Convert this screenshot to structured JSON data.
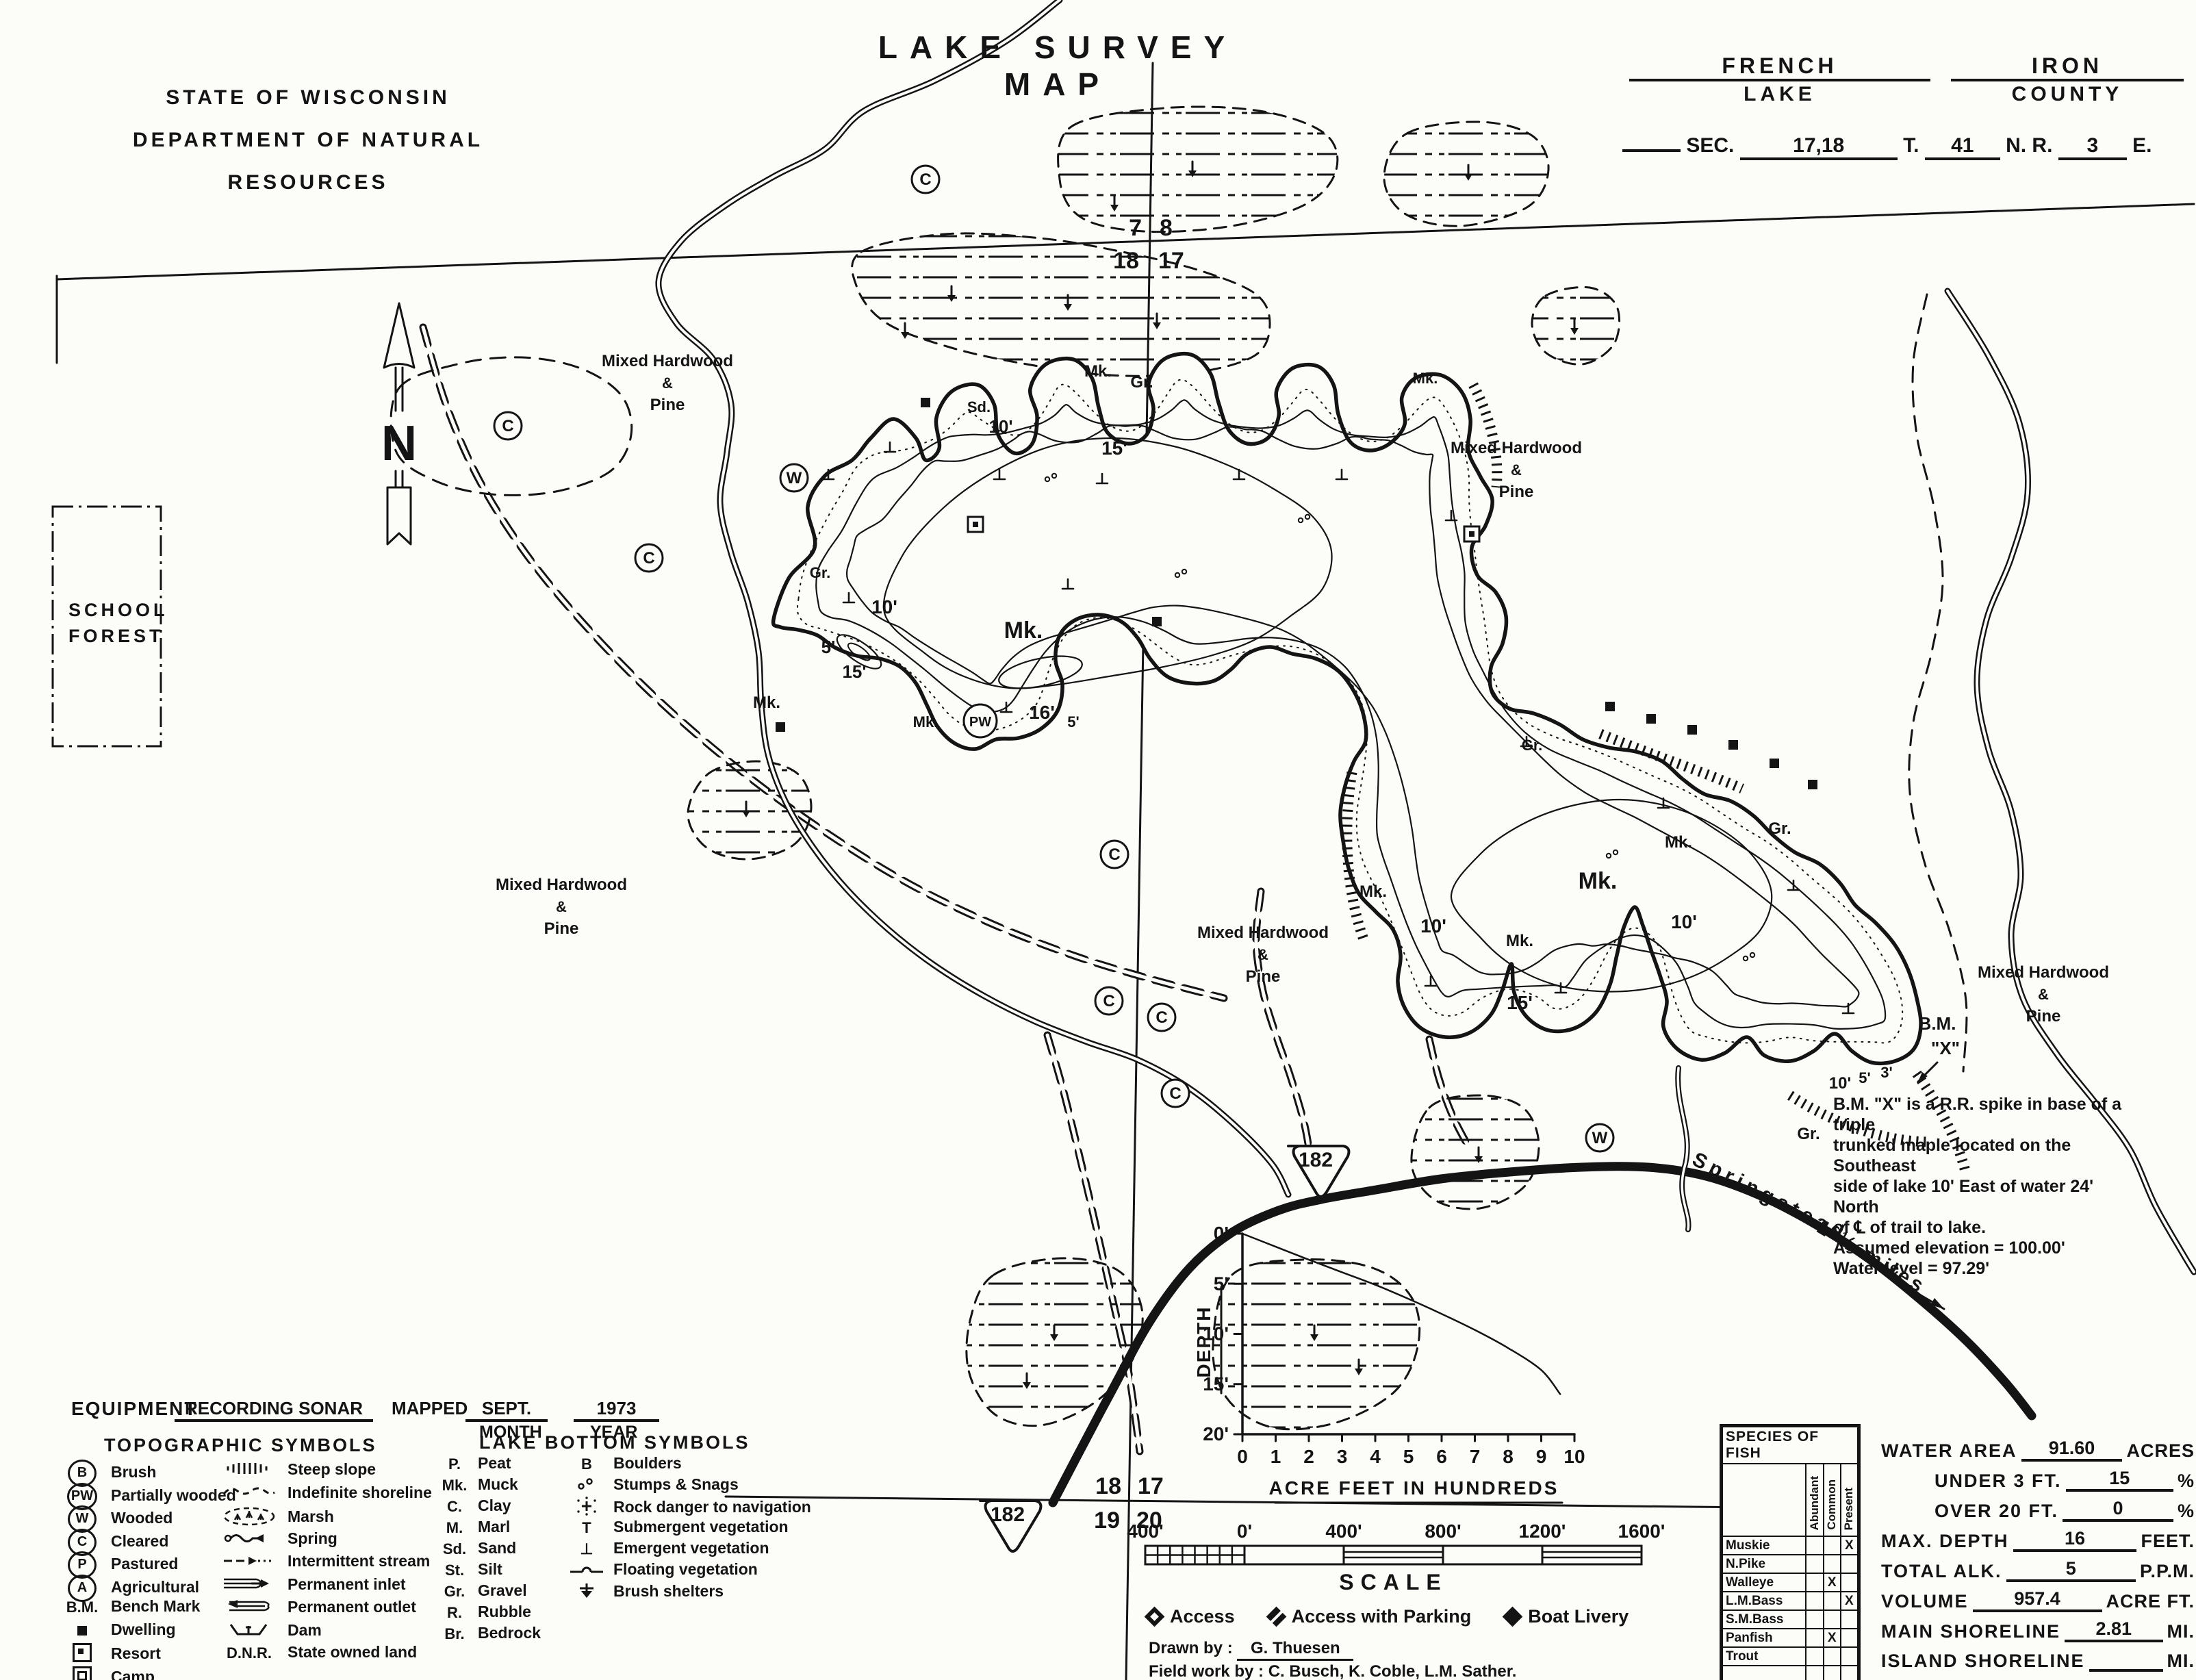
{
  "header": {
    "agency_line1": "STATE OF WISCONSIN",
    "agency_line2": "DEPARTMENT OF NATURAL RESOURCES",
    "title": "LAKE SURVEY MAP",
    "lake_value": "FRENCH",
    "lake_label": "LAKE",
    "county_value": "IRON",
    "county_label": "COUNTY",
    "sec_label": "SEC.",
    "sec_value": "17,18",
    "t_label": "T.",
    "t_value": "41",
    "nr_label": "N. R.",
    "r_value": "3",
    "e_label": "E."
  },
  "map": {
    "school_forest_line1": "SCHOOL",
    "school_forest_line2": "FOREST",
    "north_letter": "N",
    "forest_label_lines": [
      "Mixed Hardwood",
      "&",
      "Pine"
    ],
    "forest_labels": [
      {
        "x": 975,
        "y": 535
      },
      {
        "x": 2215,
        "y": 662
      },
      {
        "x": 820,
        "y": 1300
      },
      {
        "x": 1845,
        "y": 1370
      },
      {
        "x": 2985,
        "y": 1428
      }
    ],
    "section_corner_top": {
      "ul": "7",
      "ur": "8",
      "ll": "18",
      "lr": "17"
    },
    "section_corner_bottom": {
      "ul": "18",
      "ur": "17",
      "ll": "19",
      "lr": "20"
    },
    "highway_number": "182",
    "road_name": "Springstead",
    "road_distance": "1 ½ miles",
    "bm_label": "B.M.",
    "bm_x_label": "\"X\"",
    "bm_note": [
      "B.M. \"X\" is a R.R. spike in base of a triple",
      "trunked maple located on the Southeast",
      "side of lake 10' East of water 24' North",
      "of ℄ of trail to lake.",
      "Assumed elevation = 100.00'",
      "Water level = 97.29'"
    ],
    "spot_labels": [
      {
        "t": "Mk.",
        "x": 1495,
        "y": 932,
        "s": 34
      },
      {
        "t": "16'",
        "x": 1522,
        "y": 1050,
        "s": 28
      },
      {
        "t": "10'",
        "x": 1292,
        "y": 896,
        "s": 28
      },
      {
        "t": "5'",
        "x": 1210,
        "y": 954,
        "s": 26
      },
      {
        "t": "15'",
        "x": 1248,
        "y": 990,
        "s": 26
      },
      {
        "t": "15'",
        "x": 1628,
        "y": 664,
        "s": 28
      },
      {
        "t": "10'",
        "x": 1462,
        "y": 632,
        "s": 26
      },
      {
        "t": "Mk.",
        "x": 1604,
        "y": 550,
        "s": 24
      },
      {
        "t": "Gr.",
        "x": 1668,
        "y": 566,
        "s": 24
      },
      {
        "t": "Sd.",
        "x": 1430,
        "y": 602,
        "s": 22
      },
      {
        "t": "Mk.",
        "x": 1120,
        "y": 1034,
        "s": 24
      },
      {
        "t": "Gr.",
        "x": 1198,
        "y": 844,
        "s": 22
      },
      {
        "t": "Mk.",
        "x": 2334,
        "y": 1298,
        "s": 34
      },
      {
        "t": "15'",
        "x": 2220,
        "y": 1474,
        "s": 28
      },
      {
        "t": "10'",
        "x": 2094,
        "y": 1362,
        "s": 28
      },
      {
        "t": "Mk.",
        "x": 2006,
        "y": 1310,
        "s": 24
      },
      {
        "t": "Mk.",
        "x": 2220,
        "y": 1382,
        "s": 24
      },
      {
        "t": "10'",
        "x": 2460,
        "y": 1356,
        "s": 28
      },
      {
        "t": "Mk.",
        "x": 2452,
        "y": 1238,
        "s": 24
      },
      {
        "t": "Gr.",
        "x": 2600,
        "y": 1218,
        "s": 24
      },
      {
        "t": "10'",
        "x": 2688,
        "y": 1590,
        "s": 24
      },
      {
        "t": "5'",
        "x": 2724,
        "y": 1582,
        "s": 22
      },
      {
        "t": "3'",
        "x": 2756,
        "y": 1574,
        "s": 22
      },
      {
        "t": "Gr.",
        "x": 2642,
        "y": 1664,
        "s": 24
      },
      {
        "t": "Gr.",
        "x": 2238,
        "y": 1096,
        "s": 22
      },
      {
        "t": "Mk.",
        "x": 1352,
        "y": 1062,
        "s": 22
      },
      {
        "t": "5'",
        "x": 1568,
        "y": 1062,
        "s": 22
      },
      {
        "t": "Mk.",
        "x": 2082,
        "y": 560,
        "s": 22
      }
    ],
    "circled_letters": [
      {
        "t": "C",
        "x": 1352,
        "y": 262
      },
      {
        "t": "C",
        "x": 742,
        "y": 622
      },
      {
        "t": "C",
        "x": 948,
        "y": 815
      },
      {
        "t": "W",
        "x": 1160,
        "y": 698
      },
      {
        "t": "PW",
        "x": 1432,
        "y": 1053
      },
      {
        "t": "C",
        "x": 1628,
        "y": 1248
      },
      {
        "t": "C",
        "x": 1620,
        "y": 1462
      },
      {
        "t": "C",
        "x": 1697,
        "y": 1486
      },
      {
        "t": "C",
        "x": 1717,
        "y": 1597
      },
      {
        "t": "W",
        "x": 2337,
        "y": 1662
      }
    ]
  },
  "chart_data": {
    "type": "line",
    "title": "",
    "xlabel": "ACRE FEET IN HUNDREDS",
    "ylabel": "DEPTH",
    "x_ticks": [
      "0",
      "1",
      "2",
      "3",
      "4",
      "5",
      "6",
      "7",
      "8",
      "9",
      "10"
    ],
    "y_ticks": [
      "0'",
      "5'",
      "10'",
      "15'",
      "20'"
    ],
    "xlim": [
      0,
      10
    ],
    "ylim": [
      20,
      0
    ],
    "grid": false,
    "series": [
      {
        "name": "depth-vs-volume",
        "x": [
          0,
          1,
          2,
          3,
          4,
          5,
          6,
          7,
          8,
          9,
          9.57
        ],
        "y": [
          0,
          1.3,
          2.6,
          3.85,
          5.1,
          6.5,
          8.0,
          9.6,
          11.4,
          13.6,
          16
        ]
      }
    ]
  },
  "equipment": {
    "label": "EQUIPMENT",
    "value": "RECORDING SONAR",
    "mapped_label": "MAPPED",
    "month_value": "SEPT.",
    "year_value": "1973",
    "month_label": "MONTH",
    "year_label": "YEAR"
  },
  "topo_legend": {
    "title": "TOPOGRAPHIC SYMBOLS",
    "left": [
      {
        "icon": "circle-b",
        "label": "Brush"
      },
      {
        "icon": "circle-pw",
        "label": "Partially wooded"
      },
      {
        "icon": "circle-w",
        "label": "Wooded"
      },
      {
        "icon": "circle-c",
        "label": "Cleared"
      },
      {
        "icon": "circle-p",
        "label": "Pastured"
      },
      {
        "icon": "circle-a",
        "label": "Agricultural"
      },
      {
        "icon": "bench-mark",
        "label": "Bench Mark"
      },
      {
        "icon": "dwelling",
        "label": "Dwelling"
      },
      {
        "icon": "resort",
        "label": "Resort"
      },
      {
        "icon": "camp",
        "label": "Camp"
      }
    ],
    "right": [
      {
        "icon": "steep-slope",
        "label": "Steep slope"
      },
      {
        "icon": "indefinite-shoreline",
        "label": "Indefinite shoreline"
      },
      {
        "icon": "marsh",
        "label": "Marsh"
      },
      {
        "icon": "spring",
        "label": "Spring"
      },
      {
        "icon": "intermittent-stream",
        "label": "Intermittent stream"
      },
      {
        "icon": "permanent-inlet",
        "label": "Permanent inlet"
      },
      {
        "icon": "permanent-outlet",
        "label": "Permanent outlet"
      },
      {
        "icon": "dam",
        "label": "Dam"
      },
      {
        "icon": "dnr",
        "label": "State owned land"
      }
    ]
  },
  "bottom_legend": {
    "title": "LAKE BOTTOM SYMBOLS",
    "left": [
      {
        "abbr": "P.",
        "label": "Peat"
      },
      {
        "abbr": "Mk.",
        "label": "Muck"
      },
      {
        "abbr": "C.",
        "label": "Clay"
      },
      {
        "abbr": "M.",
        "label": "Marl"
      },
      {
        "abbr": "Sd.",
        "label": "Sand"
      },
      {
        "abbr": "St.",
        "label": "Silt"
      },
      {
        "abbr": "Gr.",
        "label": "Gravel"
      },
      {
        "abbr": "R.",
        "label": "Rubble"
      },
      {
        "abbr": "Br.",
        "label": "Bedrock"
      }
    ],
    "right": [
      {
        "icon": "boulders",
        "label": "Boulders"
      },
      {
        "icon": "stumps-snags",
        "label": "Stumps & Snags"
      },
      {
        "icon": "rock-danger",
        "label": "Rock danger to navigation"
      },
      {
        "icon": "submergent",
        "label": "Submergent vegetation"
      },
      {
        "icon": "emergent",
        "label": "Emergent vegetation"
      },
      {
        "icon": "floating",
        "label": "Floating vegetation"
      },
      {
        "icon": "brush-shelters",
        "label": "Brush shelters"
      }
    ]
  },
  "scalebar": {
    "labels": [
      "400'",
      "0'",
      "400'",
      "800'",
      "1200'",
      "1600'"
    ],
    "caption": "SCALE"
  },
  "access_legend": [
    {
      "icon": "access-diamond",
      "label": "Access"
    },
    {
      "icon": "access-parking-diamond",
      "label": "Access with Parking"
    },
    {
      "icon": "boat-livery-diamond",
      "label": "Boat Livery"
    }
  ],
  "credits": {
    "drawn_label": "Drawn by :",
    "drawn_value": "G. Thuesen",
    "field_label": "Field work by :",
    "field_value": "C. Busch, K. Coble, L.M. Sather."
  },
  "fish_table": {
    "title": "SPECIES OF FISH",
    "columns": [
      "Abundant",
      "Common",
      "Present"
    ],
    "rows": [
      {
        "name": "Muskie",
        "marks": [
          "",
          "",
          "X"
        ]
      },
      {
        "name": "N.Pike",
        "marks": [
          "",
          "",
          ""
        ]
      },
      {
        "name": "Walleye",
        "marks": [
          "",
          "X",
          ""
        ]
      },
      {
        "name": "L.M.Bass",
        "marks": [
          "",
          "",
          "X"
        ]
      },
      {
        "name": "S.M.Bass",
        "marks": [
          "",
          "",
          ""
        ]
      },
      {
        "name": "Panfish",
        "marks": [
          "",
          "X",
          ""
        ]
      },
      {
        "name": "Trout",
        "marks": [
          "",
          "",
          ""
        ]
      }
    ]
  },
  "stats": {
    "rows": [
      {
        "label": "WATER AREA",
        "value": "91.60",
        "unit": "ACRES",
        "indent": false
      },
      {
        "label": "UNDER 3 FT.",
        "value": "15",
        "unit": "%",
        "indent": true
      },
      {
        "label": "OVER 20 FT.",
        "value": "0",
        "unit": "%",
        "indent": true
      },
      {
        "label": "MAX. DEPTH",
        "value": "16",
        "unit": "FEET.",
        "indent": false
      },
      {
        "label": "TOTAL ALK.",
        "value": "5",
        "unit": "P.P.M.",
        "indent": false
      },
      {
        "label": "VOLUME",
        "value": "957.4",
        "unit": "ACRE FT.",
        "indent": false
      },
      {
        "label": "MAIN SHORELINE",
        "value": "2.81",
        "unit": "MI.",
        "indent": false
      },
      {
        "label": "ISLAND SHORELINE",
        "value": "",
        "unit": "MI.",
        "indent": false
      }
    ]
  }
}
